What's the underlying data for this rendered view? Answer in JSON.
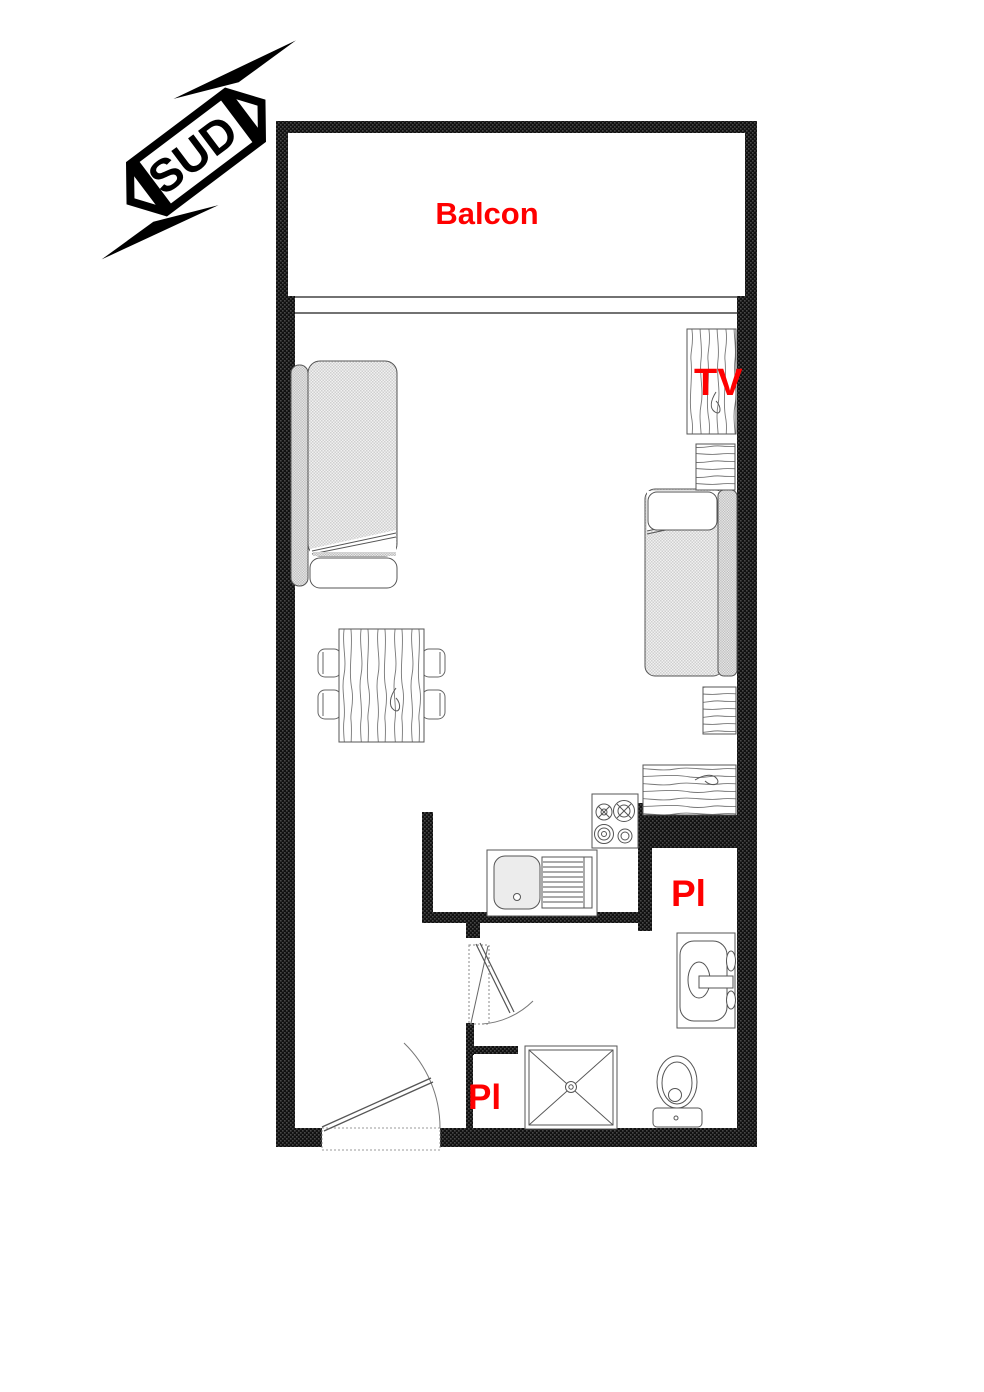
{
  "plan": {
    "compass": {
      "label": "SUD"
    },
    "labels": {
      "balcony": "Balcon",
      "tv": "TV",
      "closet_upper": "Pl",
      "closet_lower": "Pl"
    },
    "colors": {
      "label": "#ff0000",
      "wall": "#000000"
    }
  }
}
